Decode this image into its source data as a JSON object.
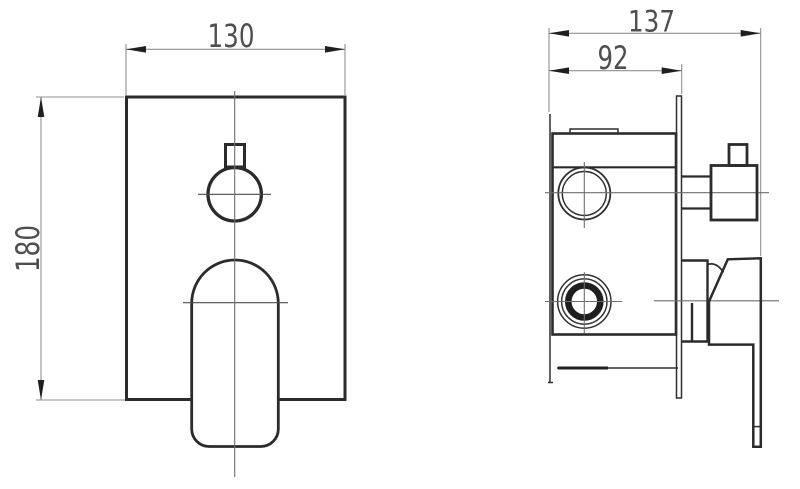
{
  "drawing": {
    "background": "#ffffff",
    "colors": {
      "outline": "#2b2b2b",
      "dimension_lines": "#8f8f8f",
      "centerlines": "#6e6e6e",
      "arrowheads": "#1f1f1f",
      "text": "#4f4f4f"
    },
    "dimensions": {
      "front_width": "130",
      "front_height": "180",
      "side_total_depth": "137",
      "side_body_depth": "92"
    }
  }
}
